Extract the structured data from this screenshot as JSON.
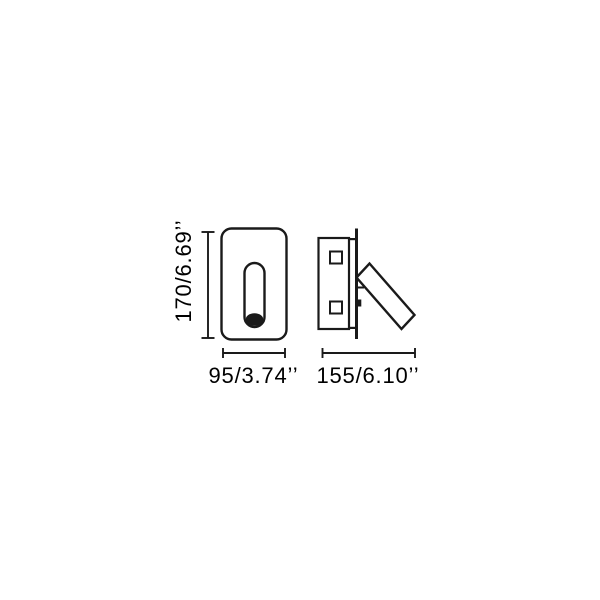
{
  "diagram": {
    "type": "technical-dimension-drawing",
    "colors": {
      "line": "#1a1a1a",
      "text": "#000000",
      "background": "#ffffff"
    },
    "dimension_labels": {
      "height": "170/6.69’’",
      "front_width": "95/3.74’’",
      "side_width": "155/6.10’’"
    },
    "views": [
      {
        "name": "front-view"
      },
      {
        "name": "side-view"
      }
    ]
  }
}
